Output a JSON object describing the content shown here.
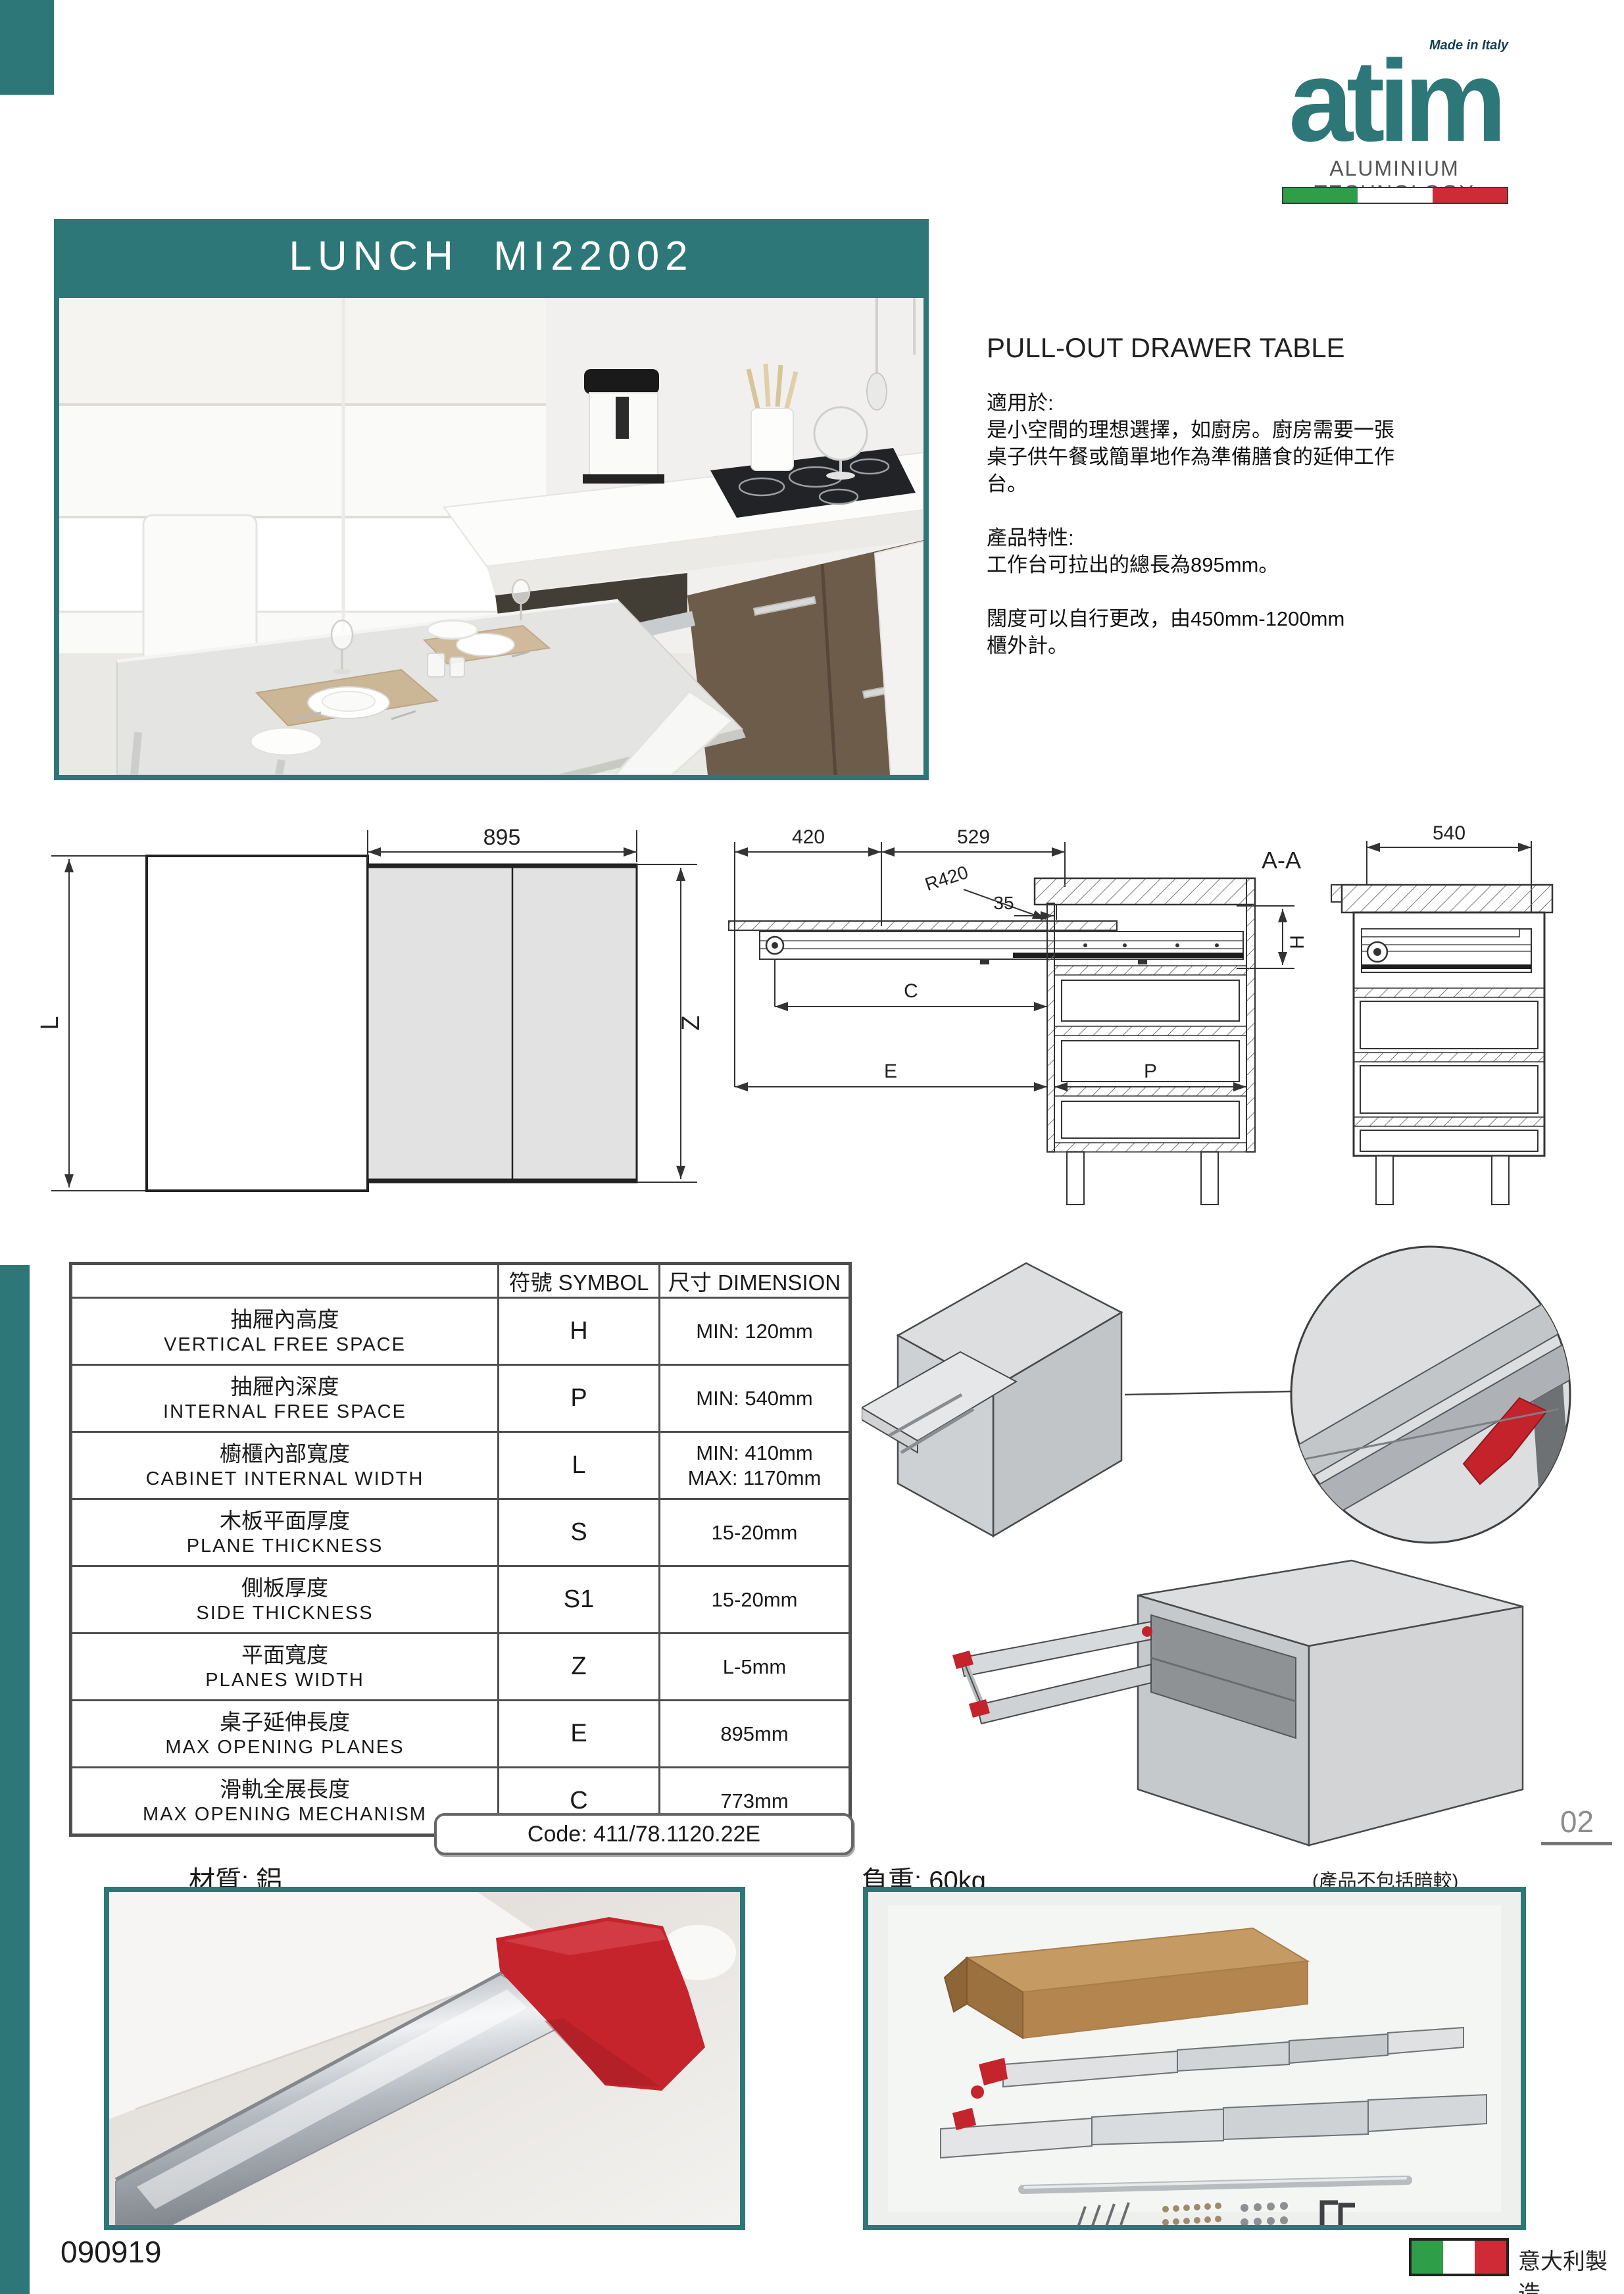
{
  "colors": {
    "teal": "#2e7778",
    "accent_red": "#c4232c",
    "flag_green": "#2f9e49",
    "flag_red": "#ce2b37"
  },
  "logo": {
    "name": "atim",
    "made_in": "Made in Italy",
    "tagline": "ALUMINIUM TECHNOLOGY"
  },
  "header": {
    "title": "LUNCH  MI22002"
  },
  "intro": {
    "product_name": "PULL-OUT DRAWER TABLE",
    "usage_label": "適用於:",
    "usage_text": "是小空間的理想選擇，如廚房。廚房需要一張\n桌子供午餐或簡單地作為準備膳食的延伸工作\n台。",
    "features_label": "產品特性:",
    "feature_text": "工作台可拉出的總長為895mm。",
    "width_text": "闊度可以自行更改，由450mm-1200mm\n櫃外計。"
  },
  "drawings": {
    "plan": {
      "width": "895",
      "left": "L",
      "right": "Z"
    },
    "section": {
      "view": "A-A",
      "dim_420": "420",
      "dim_529": "529",
      "radius": "R420",
      "dim_35": "35",
      "h": "H",
      "c": "C",
      "e": "E",
      "p": "P"
    },
    "side": {
      "width": "540"
    }
  },
  "spec_table": {
    "symbol_header": "符號 SYMBOL",
    "dimension_header": "尺寸 DIMENSION",
    "rows": [
      {
        "zh": "抽屜內高度",
        "en": "VERTICAL FREE SPACE",
        "symbol": "H",
        "dimension": "MIN: 120mm"
      },
      {
        "zh": "抽屜內深度",
        "en": "INTERNAL FREE SPACE",
        "symbol": "P",
        "dimension": "MIN: 540mm"
      },
      {
        "zh": "櫥櫃內部寬度",
        "en": "CABINET INTERNAL WIDTH",
        "symbol": "L",
        "dimension": "MIN: 410mm\nMAX: 1170mm"
      },
      {
        "zh": "木板平面厚度",
        "en": "PLANE THICKNESS",
        "symbol": "S",
        "dimension": "15-20mm"
      },
      {
        "zh": "側板厚度",
        "en": "SIDE THICKNESS",
        "symbol": "S1",
        "dimension": "15-20mm"
      },
      {
        "zh": "平面寬度",
        "en": "PLANES WIDTH",
        "symbol": "Z",
        "dimension": "L-5mm"
      },
      {
        "zh": "桌子延伸長度",
        "en": "MAX OPENING PLANES",
        "symbol": "E",
        "dimension": "895mm"
      },
      {
        "zh": "滑軌全展長度",
        "en": "MAX OPENING MECHANISM",
        "symbol": "C",
        "dimension": "773mm"
      }
    ],
    "code": "Code: 411/78.1120.22E"
  },
  "details": {
    "material": "材質: 鋁",
    "load": "負重: 60kg",
    "note": "(產品不包括暗較)",
    "page_number": "02"
  },
  "footer": {
    "doc_number": "090919",
    "made_in_zh": "意大利製造"
  }
}
